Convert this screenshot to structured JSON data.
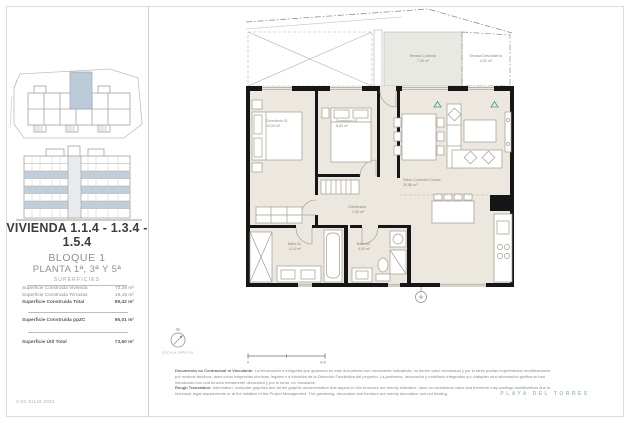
{
  "header": {
    "version": "V.03 JULIO 2022",
    "brand": "PLAYA DEL TORRES"
  },
  "unit": {
    "title_line1": "VIVIENDA 1.1.4 - 1.3.4 -",
    "title_line2": "1.5.4",
    "block": "BLOQUE 1",
    "floors": "PLANTA 1ª, 3ª Y 5ª"
  },
  "surfaces": {
    "heading": "SUPERFICIES",
    "rows": [
      {
        "label": "Superficie Construida Vivienda",
        "value": "73,26 m²"
      },
      {
        "label": "Superficie Construida Terrazas",
        "value": "16,16 m²"
      },
      {
        "label": "Superficie Construida Total",
        "value": "89,42 m²"
      },
      {
        "label": "Superficie Construida ppZC",
        "value": "95,01 m²"
      },
      {
        "label": "Superficie Útil Total",
        "value": "73,60 m²"
      }
    ]
  },
  "plan": {
    "terraza_cubierta": {
      "name": "Terraza Cubierta",
      "area": "7,08 m²"
    },
    "terraza_descubierta": {
      "name": "Terraza Descubierta",
      "area": "4,31 m²"
    },
    "dorm1": {
      "name": "Dormitorio 01",
      "area": "10,04 m²"
    },
    "dorm2": {
      "name": "Dormitorio 02",
      "area": "8,83 m²"
    },
    "salon": {
      "name": "Salón-Comedor-Cocina",
      "area": "30,86 m²"
    },
    "distribuidor": {
      "name": "Distribuidor",
      "area": "1,50 m²"
    },
    "bano1": {
      "name": "Baño 01",
      "area": "4,14 m²"
    },
    "bano2": {
      "name": "Baño 02",
      "area": "4,00 m²"
    },
    "north": "N",
    "scale_label": "ESCALA GRÁFICA",
    "scale_start": "0",
    "scale_end": "4 m"
  },
  "footer": {
    "es_title": "Documento no Contractual ni Vinculante:",
    "es_text": "La información e infografía que aparecen en este documento son meramente indicativas, no tienen valor contractual y por lo tanto podrán experimentar modificaciones por motivos técnicos, tales como exigencias técnicas, legales o a iniciativa de la Dirección Facultativa del proyecto. La jardinería, decoración y mobiliario integrados y/o cualquier otra información gráfica se han introducido con una función meramente decorativa y por lo tanto, no vinculante.",
    "en_title": "Rough Translation:",
    "en_text": "Information, computer graphics and all the graphic documentation that appear in this brochure are merely indicative, have no contractual value and therefore may undergo modifications due to technical, legal requirements or at the initiative of the Project Management. The gardening, decoration and furniture are merely decorative and not binding."
  },
  "colors": {
    "highlight": "#b9c9d8",
    "accent_teal": "#2fa189",
    "brand_blue": "#9fc0c9"
  }
}
